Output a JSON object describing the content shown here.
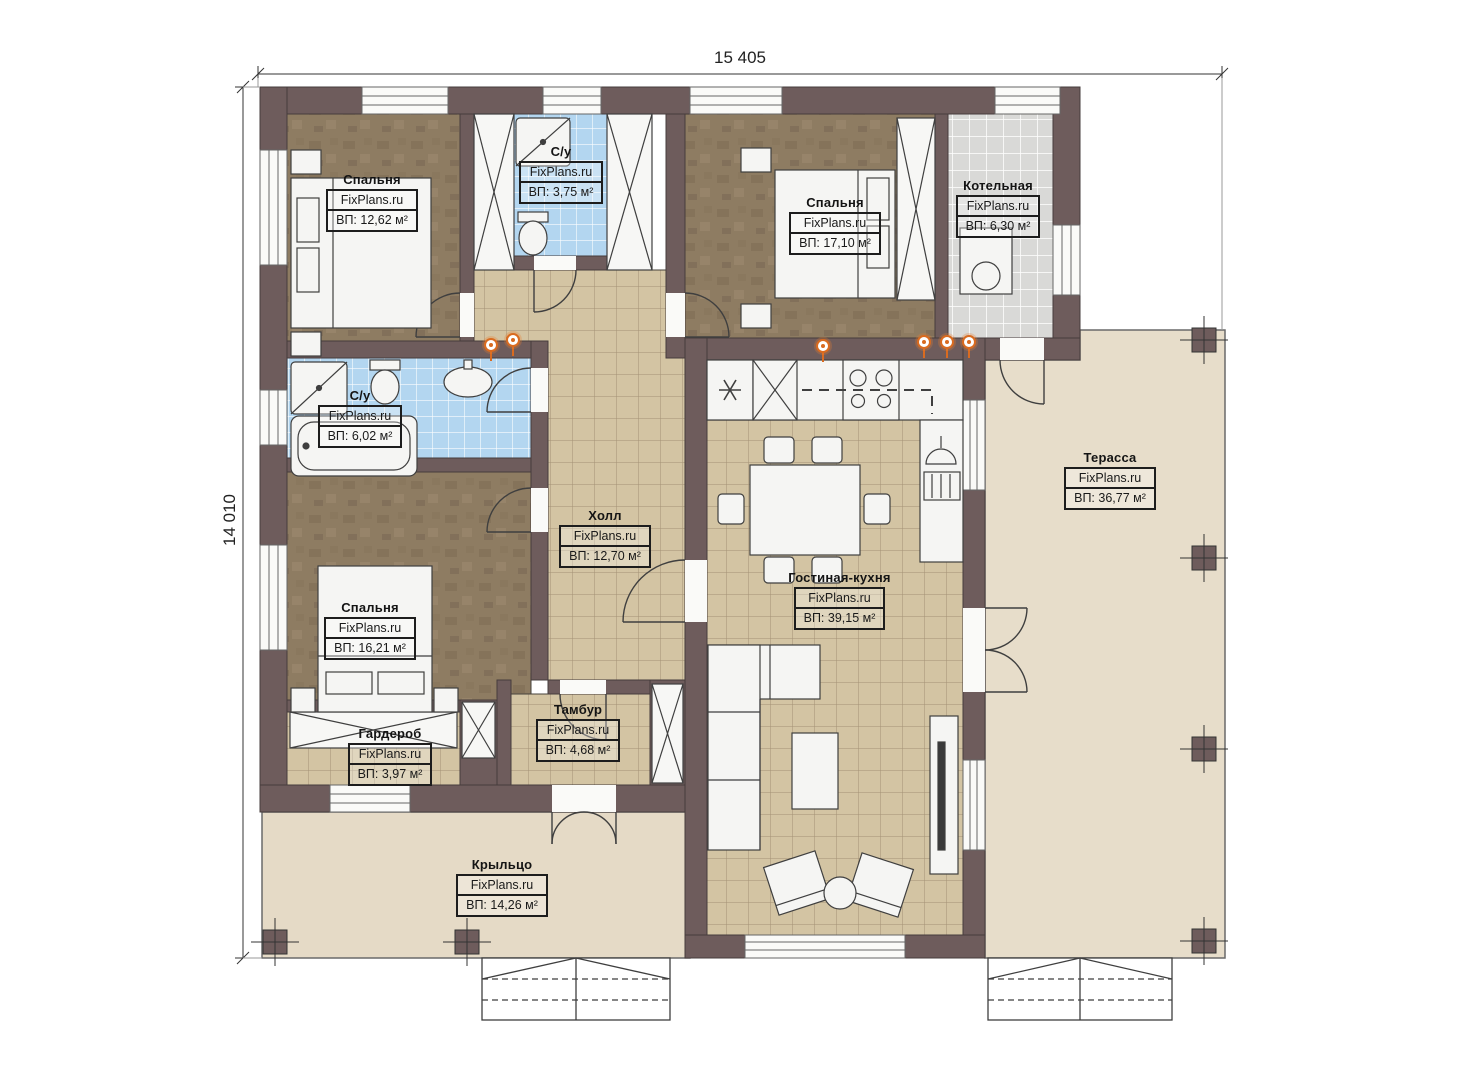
{
  "dimensions": {
    "width": "15 405",
    "height": "14 010"
  },
  "watermark": "FixPlans.ru",
  "rooms": [
    {
      "key": "bedroom-top-left",
      "name": "Спальня",
      "area": "ВП: 12,62 м²"
    },
    {
      "key": "bathroom-top",
      "name": "С/у",
      "area": "ВП: 3,75 м²"
    },
    {
      "key": "bedroom-top-right",
      "name": "Спальня",
      "area": "ВП: 17,10 м²"
    },
    {
      "key": "boiler-room",
      "name": "Котельная",
      "area": "ВП: 6,30 м²"
    },
    {
      "key": "bathroom-left",
      "name": "С/у",
      "area": "ВП: 6,02 м²"
    },
    {
      "key": "hall",
      "name": "Холл",
      "area": "ВП: 12,70 м²"
    },
    {
      "key": "bedroom-bottom-left",
      "name": "Спальня",
      "area": "ВП: 16,21 м²"
    },
    {
      "key": "wardrobe",
      "name": "Гардероб",
      "area": "ВП: 3,97 м²"
    },
    {
      "key": "vestibule",
      "name": "Тамбур",
      "area": "ВП: 4,68 м²"
    },
    {
      "key": "living-kitchen",
      "name": "Гостиная-кухня",
      "area": "ВП: 39,15 м²"
    },
    {
      "key": "terrace",
      "name": "Терасса",
      "area": "ВП: 36,77 м²"
    },
    {
      "key": "porch",
      "name": "Крыльцо",
      "area": "ВП: 14,26 м²"
    }
  ],
  "colors": {
    "wall": "#6e5c5c",
    "bedroom_floor": "#8e7c62",
    "tile_floor": "#d3c4a3",
    "bath_tile": "#b3d6f0",
    "boiler_tile": "#d9d9d7",
    "outdoor": "#e6dcc9",
    "accent_orange": "#d96b20"
  }
}
